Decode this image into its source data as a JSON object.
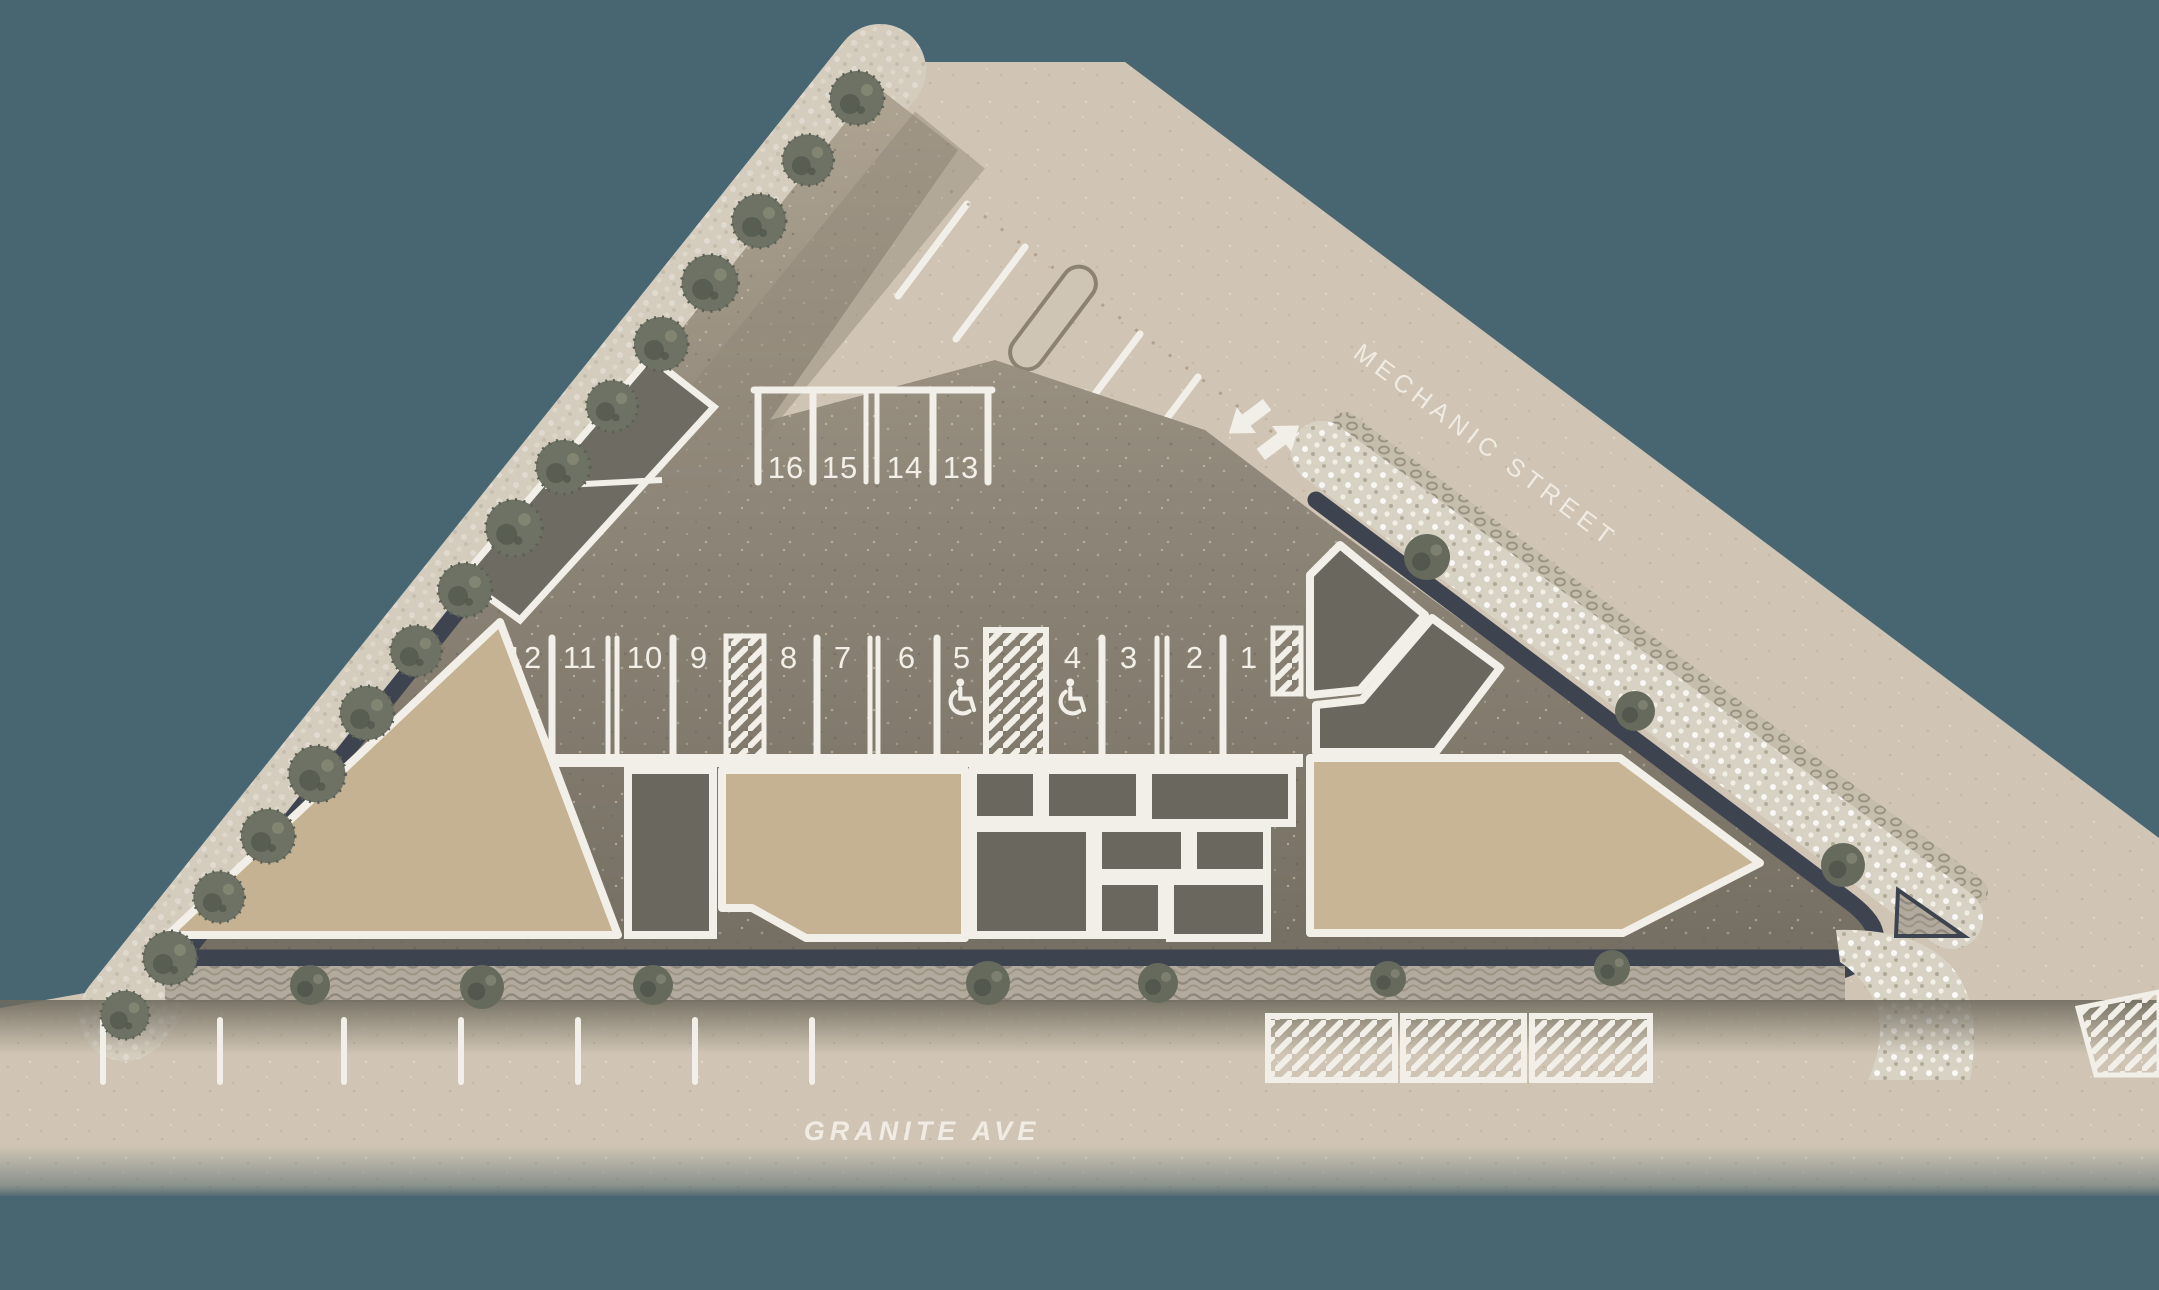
{
  "title": "Site plan with parking layout at Mechanic Street and Granite Ave",
  "streets": {
    "mechanic_label": "MECHANIC STREET",
    "granite_label": "GRANITE AVE"
  },
  "parking": {
    "row_top": {
      "spots": [
        {
          "label": "16"
        },
        {
          "label": "15"
        },
        {
          "label": "14"
        },
        {
          "label": "13"
        }
      ]
    },
    "row_main": {
      "spots": [
        {
          "label": "12"
        },
        {
          "label": "11"
        },
        {
          "label": "10"
        },
        {
          "label": "9"
        },
        {
          "label": "8"
        },
        {
          "label": "7"
        },
        {
          "label": "6"
        },
        {
          "label": "5"
        },
        {
          "label": "4"
        },
        {
          "label": "3"
        },
        {
          "label": "2"
        },
        {
          "label": "1"
        }
      ],
      "accessible_spot_labels": [
        "5",
        "4"
      ],
      "hatched_strip_count": 3
    },
    "total_numbered_spots": 16
  },
  "markings": {
    "entry_arrow": "in",
    "exit_arrow": "out",
    "granite_curb_tick_count": 7,
    "granite_hatched_zone_count": 3,
    "mechanic_street_stall_tick_count": 5
  },
  "landscape": {
    "street_tree_count": 16,
    "granite_shrub_count": 7,
    "mechanic_island_shrub_count": 3
  },
  "colors": {
    "background_teal": "#486672",
    "street_tan": "#D0C5B4",
    "lot_gray_top": "#AFA492",
    "lot_gray_bottom": "#746E62",
    "building_tan": "#C4B293",
    "dark_block": "#6A675E",
    "boundary_dark": "#3E4350",
    "line_white": "#F2EFE8",
    "tree_green_gray": "#6D7265",
    "paver_light": "#D2C9BA"
  }
}
